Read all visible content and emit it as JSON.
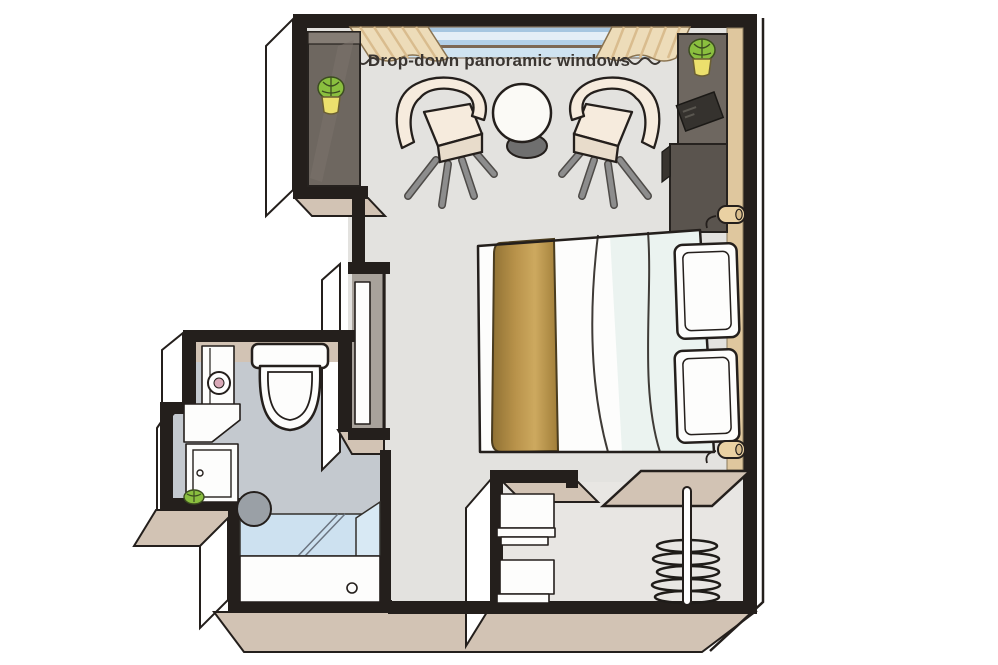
{
  "image_type": "cabin-floor-plan-illustration",
  "labels": {
    "window_label": "Drop-down panoramic windows"
  },
  "colors": {
    "wall": "#241f1c",
    "floor": "#e3e2df",
    "floor_closet": "#e8e6e3",
    "bathroom_floor": "#c4c9cf",
    "wall_top_tan": "#d2c3b4",
    "wood_panel": "#dfc79e",
    "curtain": "#eddcb9",
    "curtain_stripe": "#d9bc8e",
    "cabinet_dark": "#6e6760",
    "cabinet_darker": "#5a544e",
    "cabinet_top": "#857d75",
    "gold_dark": "#8f7133",
    "gold_mid": "#b8924a",
    "gold_light": "#cda95f",
    "glass_blue": "#cde1f0",
    "glass_wedge": "#d8e9f4",
    "window_sky1": "#a6c6e0",
    "window_sky2": "#e4eef6",
    "window_sky3": "#b3d0e8",
    "window_rail": "#7d6854",
    "window_sky4": "#cfe3f1",
    "chair_cream": "#f6ebdd",
    "chair_shade": "#e8dccb",
    "plant_green": "#8abf3f",
    "plant_vein": "#3c4d20",
    "plant_pot": "#ece06d",
    "metal_gray": "#8d8d8d",
    "label_text": "#3a3531",
    "white": "#fdfdfc",
    "stool_gray": "#9aa0a6",
    "lamp_cream": "#ead1a3",
    "recess_gray": "#a8a29b",
    "mint": "#ebf3f0",
    "mirror_pink": "#d9a9b8",
    "table_base": "#6f6f6f"
  },
  "elements": [
    "panoramic-window",
    "curtain",
    "armchair",
    "round-table",
    "double-bed",
    "gold-bed-runner",
    "pillow",
    "headboard-panel",
    "wall-lamp",
    "tall-cabinet",
    "nightstand",
    "tablet",
    "potted-plant",
    "wardrobe",
    "shelf-unit",
    "hanging-rail",
    "clothes-hanger",
    "toilet",
    "mirror-cabinet",
    "vanity-sink",
    "vanity-cabinet",
    "shower",
    "shower-glass",
    "shower-stool",
    "entry-door"
  ]
}
